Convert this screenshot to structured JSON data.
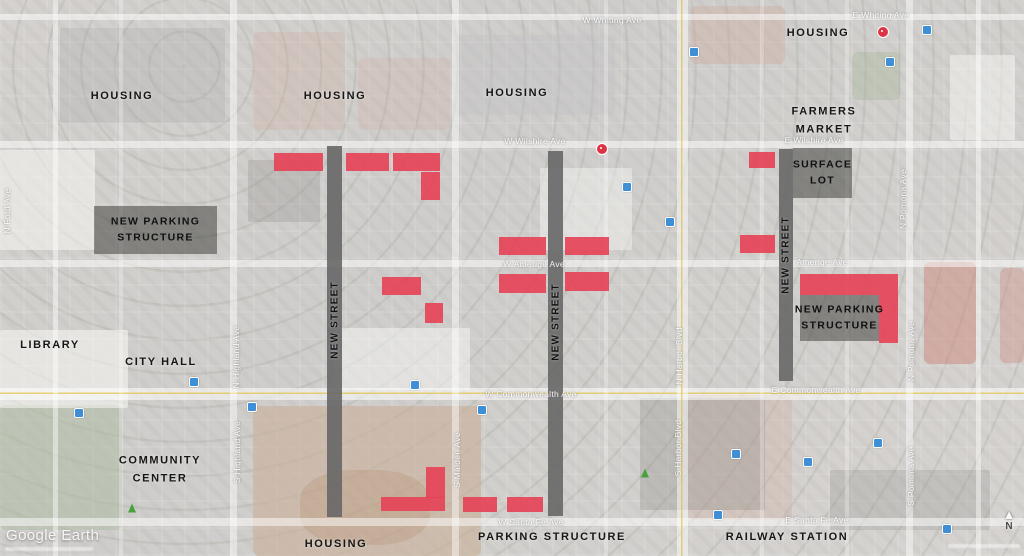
{
  "watermark": {
    "logo": "Google Earth"
  },
  "compass": {
    "label": "N"
  },
  "colors": {
    "site_red": "#e64155",
    "new_street_gray": "#676767",
    "zone_overlay": "rgba(54,54,50,0.5)"
  },
  "area_labels": [
    {
      "name": "housing-northwest",
      "lines": [
        "HOUSING"
      ],
      "x": 122,
      "y": 97
    },
    {
      "name": "housing-north",
      "lines": [
        "HOUSING"
      ],
      "x": 335,
      "y": 97
    },
    {
      "name": "housing-north-center",
      "lines": [
        "HOUSING"
      ],
      "x": 517,
      "y": 94
    },
    {
      "name": "housing-northeast",
      "lines": [
        "HOUSING"
      ],
      "x": 818,
      "y": 34
    },
    {
      "name": "farmers-market",
      "lines": [
        "FARMERS",
        "MARKET"
      ],
      "x": 824,
      "y": 121
    },
    {
      "name": "library",
      "lines": [
        "LIBRARY"
      ],
      "x": 50,
      "y": 346
    },
    {
      "name": "city-hall",
      "lines": [
        "CITY HALL"
      ],
      "x": 161,
      "y": 363
    },
    {
      "name": "community-center",
      "lines": [
        "COMMUNITY",
        "CENTER"
      ],
      "x": 160,
      "y": 470
    },
    {
      "name": "housing-south",
      "lines": [
        "HOUSING"
      ],
      "x": 336,
      "y": 545
    },
    {
      "name": "parking-structure-south",
      "lines": [
        "PARKING STRUCTURE"
      ],
      "x": 552,
      "y": 538
    },
    {
      "name": "railway-station",
      "lines": [
        "RAILWAY STATION"
      ],
      "x": 787,
      "y": 538
    }
  ],
  "zones": [
    {
      "name": "new-parking-structure-west",
      "lines": [
        "NEW PARKING",
        "STRUCTURE"
      ],
      "x": 94,
      "y": 206,
      "w": 123,
      "h": 48
    },
    {
      "name": "surface-lot",
      "lines": [
        "SURFACE",
        "LOT"
      ],
      "x": 793,
      "y": 148,
      "w": 59,
      "h": 50
    },
    {
      "name": "new-parking-structure-east",
      "lines": [
        "NEW PARKING",
        "STRUCTURE"
      ],
      "x": 800,
      "y": 295,
      "w": 79,
      "h": 46
    }
  ],
  "new_streets": [
    {
      "label": "NEW STREET",
      "x": 327,
      "y": 146,
      "w": 15,
      "h": 371,
      "label_y": 320
    },
    {
      "label": "NEW STREET",
      "x": 548,
      "y": 151,
      "w": 15,
      "h": 365,
      "label_y": 322
    },
    {
      "label": "NEW STREET",
      "x": 779,
      "y": 149,
      "w": 14,
      "h": 232,
      "label_y": 255
    }
  ],
  "red_sites": [
    {
      "x": 274,
      "y": 153,
      "w": 49,
      "h": 18
    },
    {
      "x": 346,
      "y": 153,
      "w": 43,
      "h": 18
    },
    {
      "x": 393,
      "y": 153,
      "w": 47,
      "h": 18
    },
    {
      "x": 421,
      "y": 172,
      "w": 19,
      "h": 28
    },
    {
      "x": 749,
      "y": 152,
      "w": 26,
      "h": 16
    },
    {
      "x": 499,
      "y": 237,
      "w": 47,
      "h": 18
    },
    {
      "x": 565,
      "y": 237,
      "w": 44,
      "h": 18
    },
    {
      "x": 499,
      "y": 274,
      "w": 47,
      "h": 19
    },
    {
      "x": 565,
      "y": 272,
      "w": 44,
      "h": 19
    },
    {
      "x": 740,
      "y": 235,
      "w": 35,
      "h": 18
    },
    {
      "x": 382,
      "y": 277,
      "w": 39,
      "h": 18
    },
    {
      "x": 425,
      "y": 303,
      "w": 18,
      "h": 20
    },
    {
      "x": 800,
      "y": 274,
      "w": 98,
      "h": 21
    },
    {
      "x": 879,
      "y": 295,
      "w": 19,
      "h": 48
    },
    {
      "x": 426,
      "y": 467,
      "w": 19,
      "h": 31
    },
    {
      "x": 381,
      "y": 497,
      "w": 64,
      "h": 14
    },
    {
      "x": 463,
      "y": 497,
      "w": 34,
      "h": 15
    },
    {
      "x": 507,
      "y": 497,
      "w": 36,
      "h": 15
    }
  ],
  "street_labels": [
    {
      "text": "W Whiting Ave",
      "x": 612,
      "y": 20,
      "vertical": false
    },
    {
      "text": "E Whiting Ave",
      "x": 881,
      "y": 15,
      "vertical": false
    },
    {
      "text": "W Wilshire Ave",
      "x": 535,
      "y": 141,
      "vertical": false
    },
    {
      "text": "E Wilshire Ave",
      "x": 814,
      "y": 140,
      "vertical": false
    },
    {
      "text": "W Amerige Ave",
      "x": 534,
      "y": 264,
      "vertical": false
    },
    {
      "text": "Amerige Ave",
      "x": 822,
      "y": 262,
      "vertical": false
    },
    {
      "text": "W Commonwealth Ave",
      "x": 531,
      "y": 394,
      "vertical": false
    },
    {
      "text": "E Commonwealth Ave",
      "x": 816,
      "y": 390,
      "vertical": false
    },
    {
      "text": "W Santa Fe Ave",
      "x": 531,
      "y": 522,
      "vertical": false
    },
    {
      "text": "E Santa Fe Ave",
      "x": 817,
      "y": 520,
      "vertical": false
    },
    {
      "text": "N Ford Ave",
      "x": 7,
      "y": 211,
      "vertical": true
    },
    {
      "text": "N Highland Ave",
      "x": 236,
      "y": 357,
      "vertical": true
    },
    {
      "text": "S Highland Ave",
      "x": 237,
      "y": 452,
      "vertical": true
    },
    {
      "text": "S Malden Ave",
      "x": 457,
      "y": 460,
      "vertical": true
    },
    {
      "text": "N Harbor Blvd",
      "x": 679,
      "y": 356,
      "vertical": true
    },
    {
      "text": "S Harbor Blvd",
      "x": 678,
      "y": 448,
      "vertical": true
    },
    {
      "text": "N Pomona Ave",
      "x": 903,
      "y": 199,
      "vertical": true
    },
    {
      "text": "N Pomona Ave",
      "x": 911,
      "y": 351,
      "vertical": true
    },
    {
      "text": "S Pomona Ave",
      "x": 911,
      "y": 476,
      "vertical": true
    }
  ],
  "map_icons": [
    {
      "type": "poi",
      "x": 602,
      "y": 149
    },
    {
      "type": "poi",
      "x": 883,
      "y": 32
    },
    {
      "type": "tree",
      "x": 132,
      "y": 508
    },
    {
      "type": "tree",
      "x": 645,
      "y": 473
    },
    {
      "type": "transit",
      "x": 694,
      "y": 52
    },
    {
      "type": "transit",
      "x": 927,
      "y": 30
    },
    {
      "type": "transit",
      "x": 890,
      "y": 62
    },
    {
      "type": "transit",
      "x": 627,
      "y": 187
    },
    {
      "type": "transit",
      "x": 670,
      "y": 222
    },
    {
      "type": "transit",
      "x": 194,
      "y": 382
    },
    {
      "type": "transit",
      "x": 79,
      "y": 413
    },
    {
      "type": "transit",
      "x": 252,
      "y": 407
    },
    {
      "type": "transit",
      "x": 415,
      "y": 385
    },
    {
      "type": "transit",
      "x": 482,
      "y": 410
    },
    {
      "type": "transit",
      "x": 736,
      "y": 454
    },
    {
      "type": "transit",
      "x": 808,
      "y": 462
    },
    {
      "type": "transit",
      "x": 878,
      "y": 443
    },
    {
      "type": "transit",
      "x": 718,
      "y": 515
    },
    {
      "type": "transit",
      "x": 947,
      "y": 529
    }
  ]
}
